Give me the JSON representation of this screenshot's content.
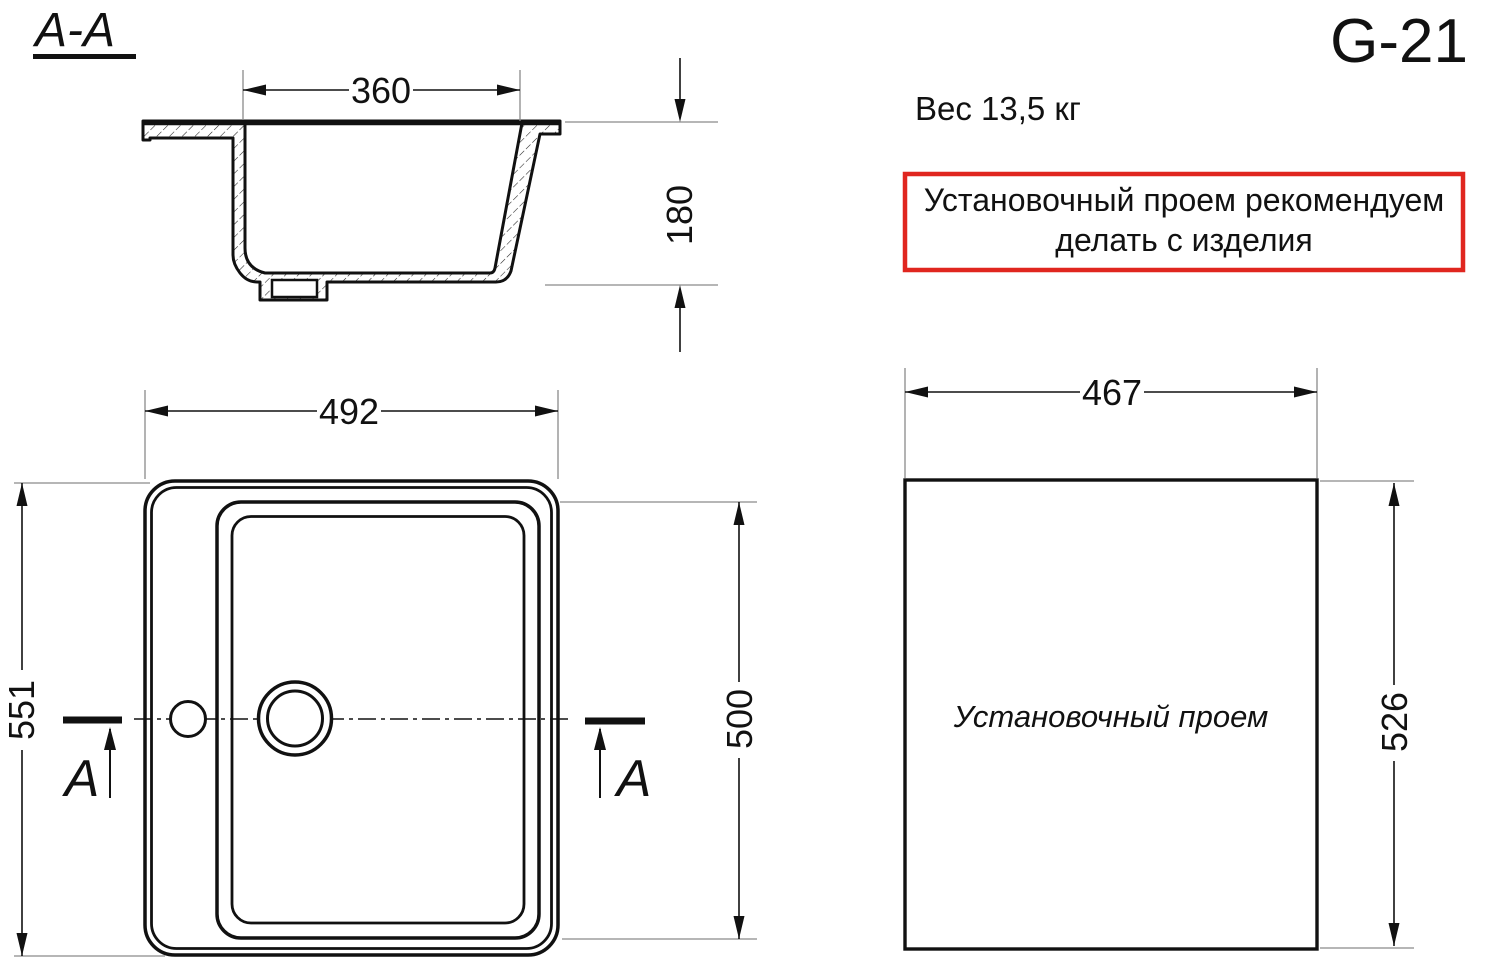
{
  "drawing": {
    "model": "G-21",
    "weight": "Вес 13,5 кг",
    "note_line1": "Установочный проем рекомендуем",
    "note_line2": "делать с изделия"
  },
  "section_view": {
    "label": "A-A",
    "cut_letter": "A",
    "dim_top_width": "360",
    "dim_depth": "180"
  },
  "plan_view": {
    "dim_width": "492",
    "dim_height_overall": "551",
    "dim_bowl_height": "500"
  },
  "install_opening": {
    "label": "Установочный проем",
    "dim_width": "467",
    "dim_height": "526"
  },
  "colors": {
    "line": "#111111",
    "extension_line": "#8a8a8a",
    "note_border": "#e0261f"
  }
}
